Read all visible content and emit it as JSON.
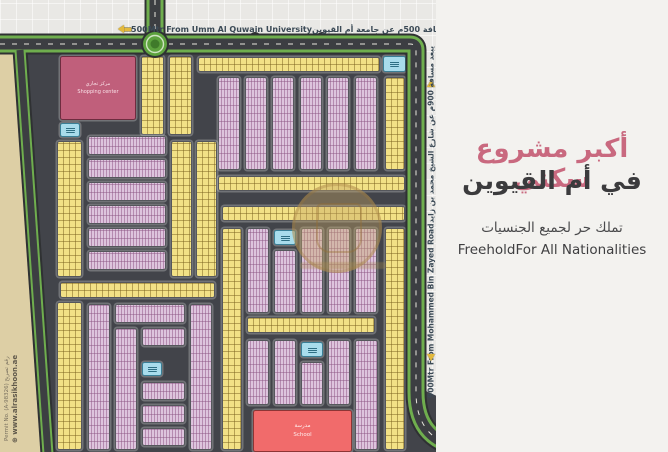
{
  "right_panel": {
    "headline_ar": "أكبر مشروع سكني",
    "headline2_ar": "في أم القيوين",
    "sub_ar": "تملك حر لجميع الجنسيات",
    "sub_en": "FreeholdFor All Nationalities",
    "headline_color": "#c9697f"
  },
  "road_labels": {
    "top_en": "500Mtr From Umm Al Quwain University",
    "top_ar": "يبعد مسافة 500م عن جامعة أم القيوين",
    "right_en": "900Mtr From Mohammed Bin Zayed Road",
    "right_ar": "يبعد مسافة 900م عن شارع الشيخ محمد بن زايد"
  },
  "footer": {
    "website": "⊕ www.alrasikhoon.ae",
    "permit": "Permit No. (A-98326) رقم تصريح"
  },
  "facilities": {
    "shopping_ar": "مركز تجاري",
    "shopping_en": "Shopping center",
    "school_ar": "مدرسة",
    "school_en": "School"
  },
  "icons": {
    "arrow": "arrow-gold",
    "globe": "globe-icon",
    "mosque": "mosque-icon"
  },
  "colors": {
    "accent_pink": "#c9697f",
    "beige_desert": "#ddcfa5",
    "yellow_plot": "#f2e186",
    "lavender_plot": "#ddc4dd",
    "mosque_blue": "#a8dcec",
    "school_red": "#f16b6b",
    "shopping_pink": "#c05f7b",
    "road_green": "#6fae4e",
    "asphalt": "#3f4145",
    "arrow_gold": "#e3b93c"
  },
  "map": {
    "blocks": [
      {
        "x": 60,
        "y": 56,
        "w": 76,
        "h": 64,
        "kind": "shopping"
      },
      {
        "x": 141,
        "y": 56,
        "w": 23,
        "h": 79,
        "kind": "yellow"
      },
      {
        "x": 169,
        "y": 56,
        "w": 23,
        "h": 79,
        "kind": "yellow"
      },
      {
        "x": 198,
        "y": 57,
        "w": 182,
        "h": 15,
        "kind": "yellow"
      },
      {
        "x": 383,
        "y": 56,
        "w": 23,
        "h": 16,
        "kind": "mosque"
      },
      {
        "x": 385,
        "y": 77,
        "w": 20,
        "h": 93,
        "kind": "yellow"
      },
      {
        "x": 218,
        "y": 77,
        "w": 22,
        "h": 93,
        "kind": "lavender"
      },
      {
        "x": 245,
        "y": 77,
        "w": 22,
        "h": 93,
        "kind": "lavender"
      },
      {
        "x": 272,
        "y": 77,
        "w": 22,
        "h": 93,
        "kind": "lavender"
      },
      {
        "x": 300,
        "y": 77,
        "w": 22,
        "h": 93,
        "kind": "lavender"
      },
      {
        "x": 327,
        "y": 77,
        "w": 22,
        "h": 93,
        "kind": "lavender"
      },
      {
        "x": 355,
        "y": 77,
        "w": 22,
        "h": 93,
        "kind": "lavender"
      },
      {
        "x": 60,
        "y": 123,
        "w": 20,
        "h": 14,
        "kind": "mosque"
      },
      {
        "x": 57,
        "y": 141,
        "w": 25,
        "h": 136,
        "kind": "yellow"
      },
      {
        "x": 88,
        "y": 136,
        "w": 78,
        "h": 19,
        "kind": "lavender"
      },
      {
        "x": 88,
        "y": 159,
        "w": 78,
        "h": 19,
        "kind": "lavender"
      },
      {
        "x": 88,
        "y": 182,
        "w": 78,
        "h": 19,
        "kind": "lavender"
      },
      {
        "x": 88,
        "y": 205,
        "w": 78,
        "h": 19,
        "kind": "lavender"
      },
      {
        "x": 88,
        "y": 228,
        "w": 78,
        "h": 19,
        "kind": "lavender"
      },
      {
        "x": 88,
        "y": 251,
        "w": 78,
        "h": 19,
        "kind": "lavender"
      },
      {
        "x": 171,
        "y": 141,
        "w": 21,
        "h": 136,
        "kind": "yellow"
      },
      {
        "x": 196,
        "y": 141,
        "w": 21,
        "h": 136,
        "kind": "yellow"
      },
      {
        "x": 218,
        "y": 176,
        "w": 187,
        "h": 15,
        "kind": "yellow"
      },
      {
        "x": 222,
        "y": 206,
        "w": 183,
        "h": 15,
        "kind": "yellow"
      },
      {
        "x": 222,
        "y": 228,
        "w": 20,
        "h": 222,
        "kind": "yellow"
      },
      {
        "x": 247,
        "y": 228,
        "w": 22,
        "h": 85,
        "kind": "lavender"
      },
      {
        "x": 274,
        "y": 250,
        "w": 22,
        "h": 63,
        "kind": "lavender"
      },
      {
        "x": 274,
        "y": 230,
        "w": 22,
        "h": 15,
        "kind": "mosque"
      },
      {
        "x": 301,
        "y": 228,
        "w": 22,
        "h": 85,
        "kind": "lavender"
      },
      {
        "x": 328,
        "y": 228,
        "w": 22,
        "h": 85,
        "kind": "lavender"
      },
      {
        "x": 355,
        "y": 228,
        "w": 22,
        "h": 85,
        "kind": "lavender"
      },
      {
        "x": 385,
        "y": 228,
        "w": 20,
        "h": 222,
        "kind": "yellow"
      },
      {
        "x": 60,
        "y": 282,
        "w": 155,
        "h": 16,
        "kind": "yellow"
      },
      {
        "x": 57,
        "y": 302,
        "w": 25,
        "h": 148,
        "kind": "yellow"
      },
      {
        "x": 88,
        "y": 304,
        "w": 22,
        "h": 146,
        "kind": "lavender"
      },
      {
        "x": 115,
        "y": 304,
        "w": 70,
        "h": 19,
        "kind": "lavender"
      },
      {
        "x": 115,
        "y": 328,
        "w": 22,
        "h": 122,
        "kind": "lavender"
      },
      {
        "x": 142,
        "y": 328,
        "w": 43,
        "h": 18,
        "kind": "lavender"
      },
      {
        "x": 142,
        "y": 362,
        "w": 20,
        "h": 14,
        "kind": "mosque"
      },
      {
        "x": 142,
        "y": 382,
        "w": 43,
        "h": 18,
        "kind": "lavender"
      },
      {
        "x": 142,
        "y": 405,
        "w": 43,
        "h": 18,
        "kind": "lavender"
      },
      {
        "x": 142,
        "y": 428,
        "w": 43,
        "h": 18,
        "kind": "lavender"
      },
      {
        "x": 190,
        "y": 304,
        "w": 22,
        "h": 146,
        "kind": "lavender"
      },
      {
        "x": 247,
        "y": 317,
        "w": 128,
        "h": 16,
        "kind": "yellow"
      },
      {
        "x": 247,
        "y": 340,
        "w": 22,
        "h": 65,
        "kind": "lavender"
      },
      {
        "x": 274,
        "y": 340,
        "w": 22,
        "h": 65,
        "kind": "lavender"
      },
      {
        "x": 301,
        "y": 362,
        "w": 22,
        "h": 43,
        "kind": "lavender"
      },
      {
        "x": 301,
        "y": 342,
        "w": 22,
        "h": 15,
        "kind": "mosque"
      },
      {
        "x": 328,
        "y": 340,
        "w": 22,
        "h": 65,
        "kind": "lavender"
      },
      {
        "x": 355,
        "y": 340,
        "w": 23,
        "h": 110,
        "kind": "lavender"
      },
      {
        "x": 253,
        "y": 410,
        "w": 99,
        "h": 42,
        "kind": "school"
      }
    ]
  }
}
